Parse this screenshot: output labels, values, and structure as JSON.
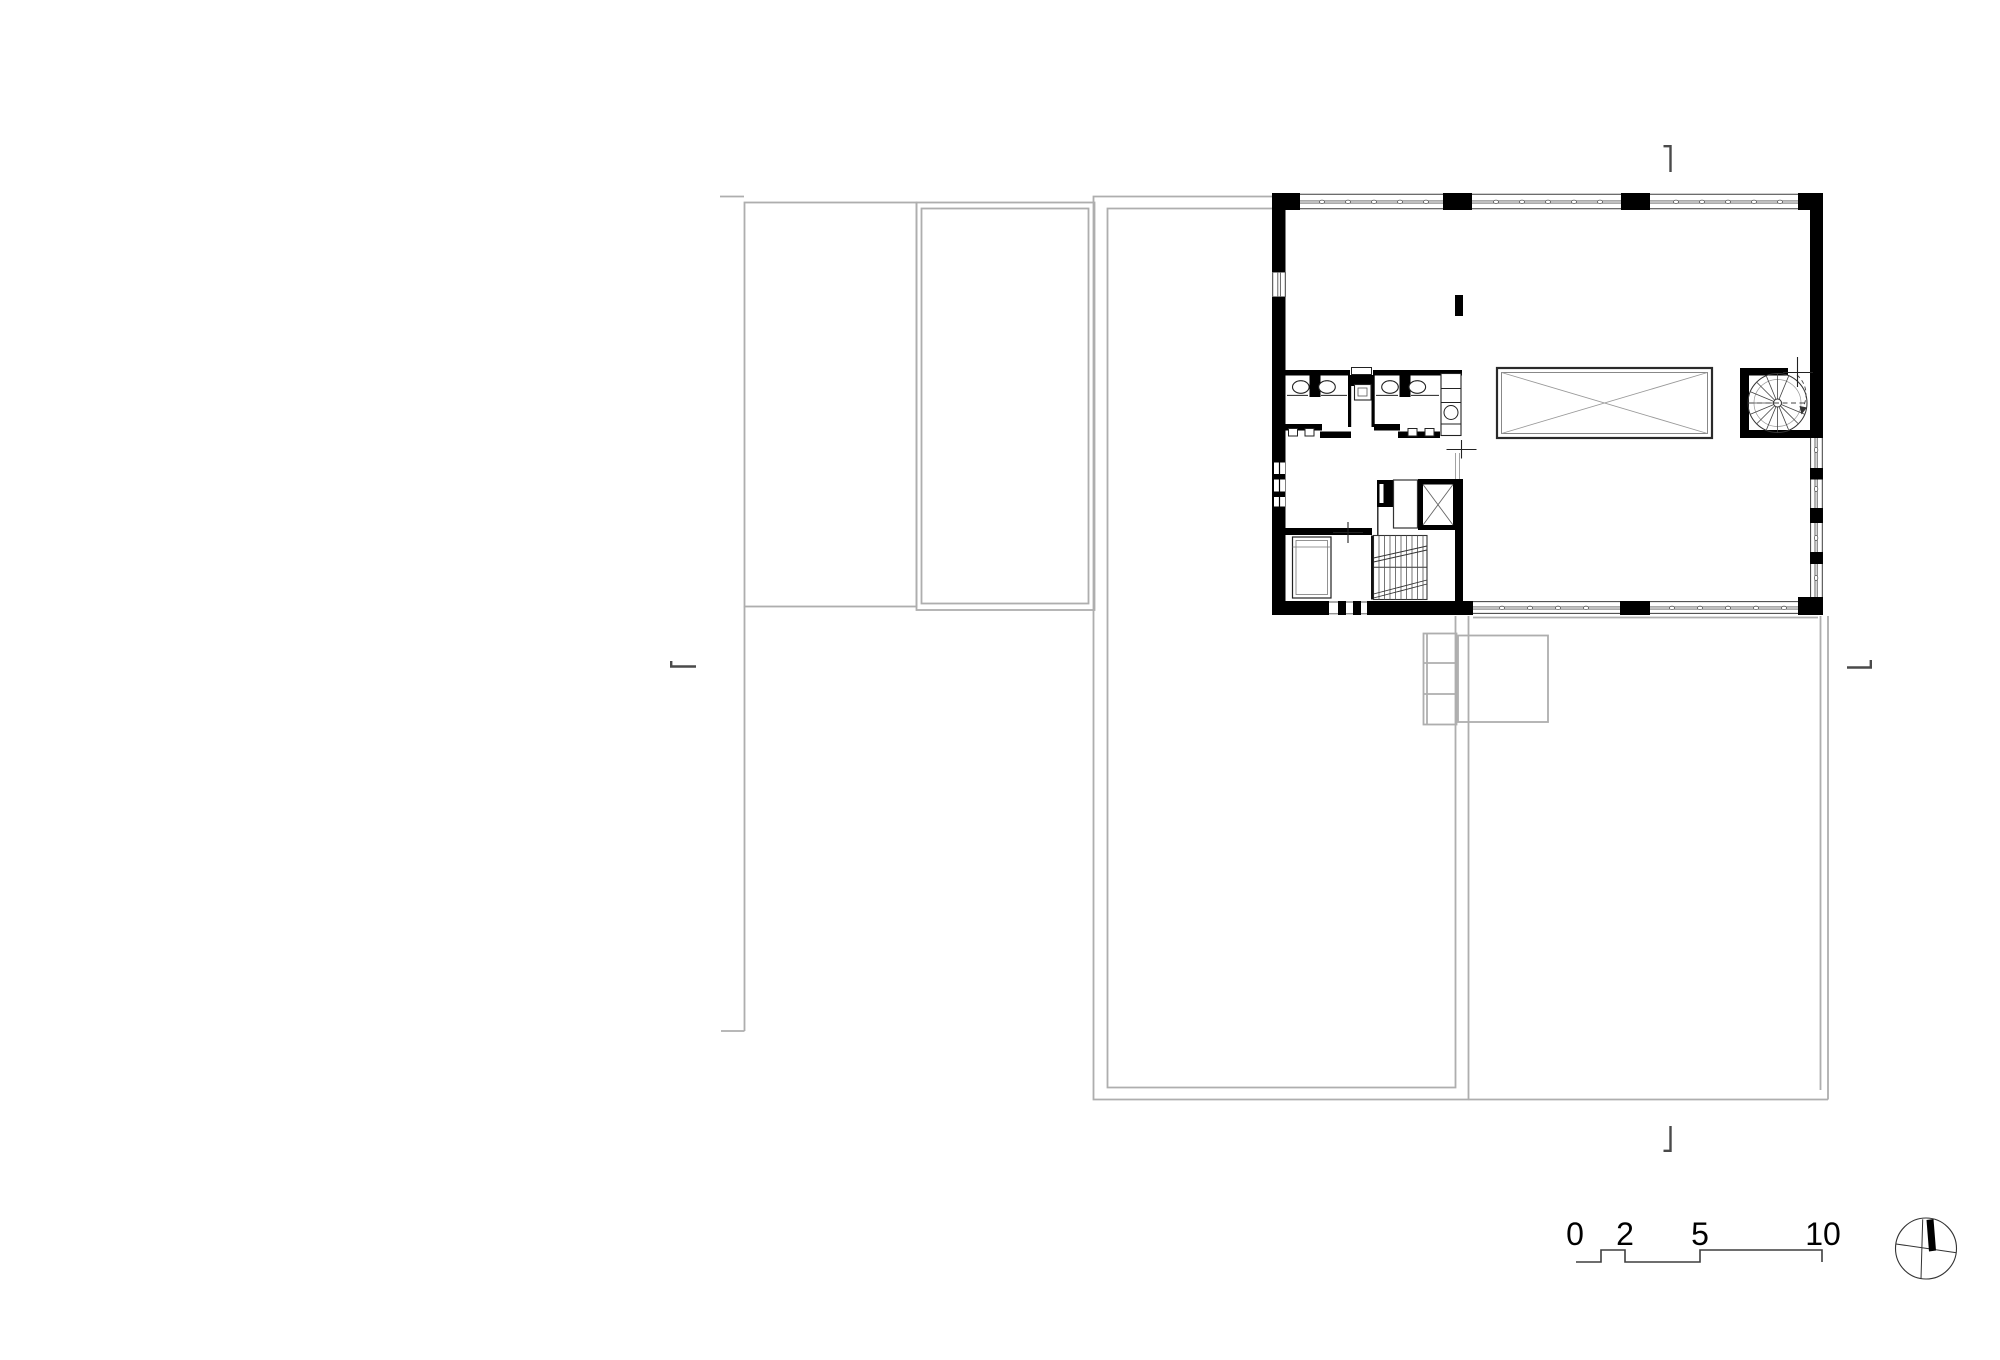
{
  "document": {
    "background": "#ffffff",
    "palette": {
      "wall": "#000000",
      "underlay": "#aeaeae",
      "detail": "#3c3c3c",
      "fixture": "#1e1e1e"
    }
  },
  "scale_bar": {
    "labels": [
      "0",
      "2",
      "5",
      "10"
    ]
  },
  "icons": {
    "north_arrow": "north-arrow-icon",
    "section_marker": "section-cut-marker",
    "survey_cross": "survey-cross-marker"
  }
}
